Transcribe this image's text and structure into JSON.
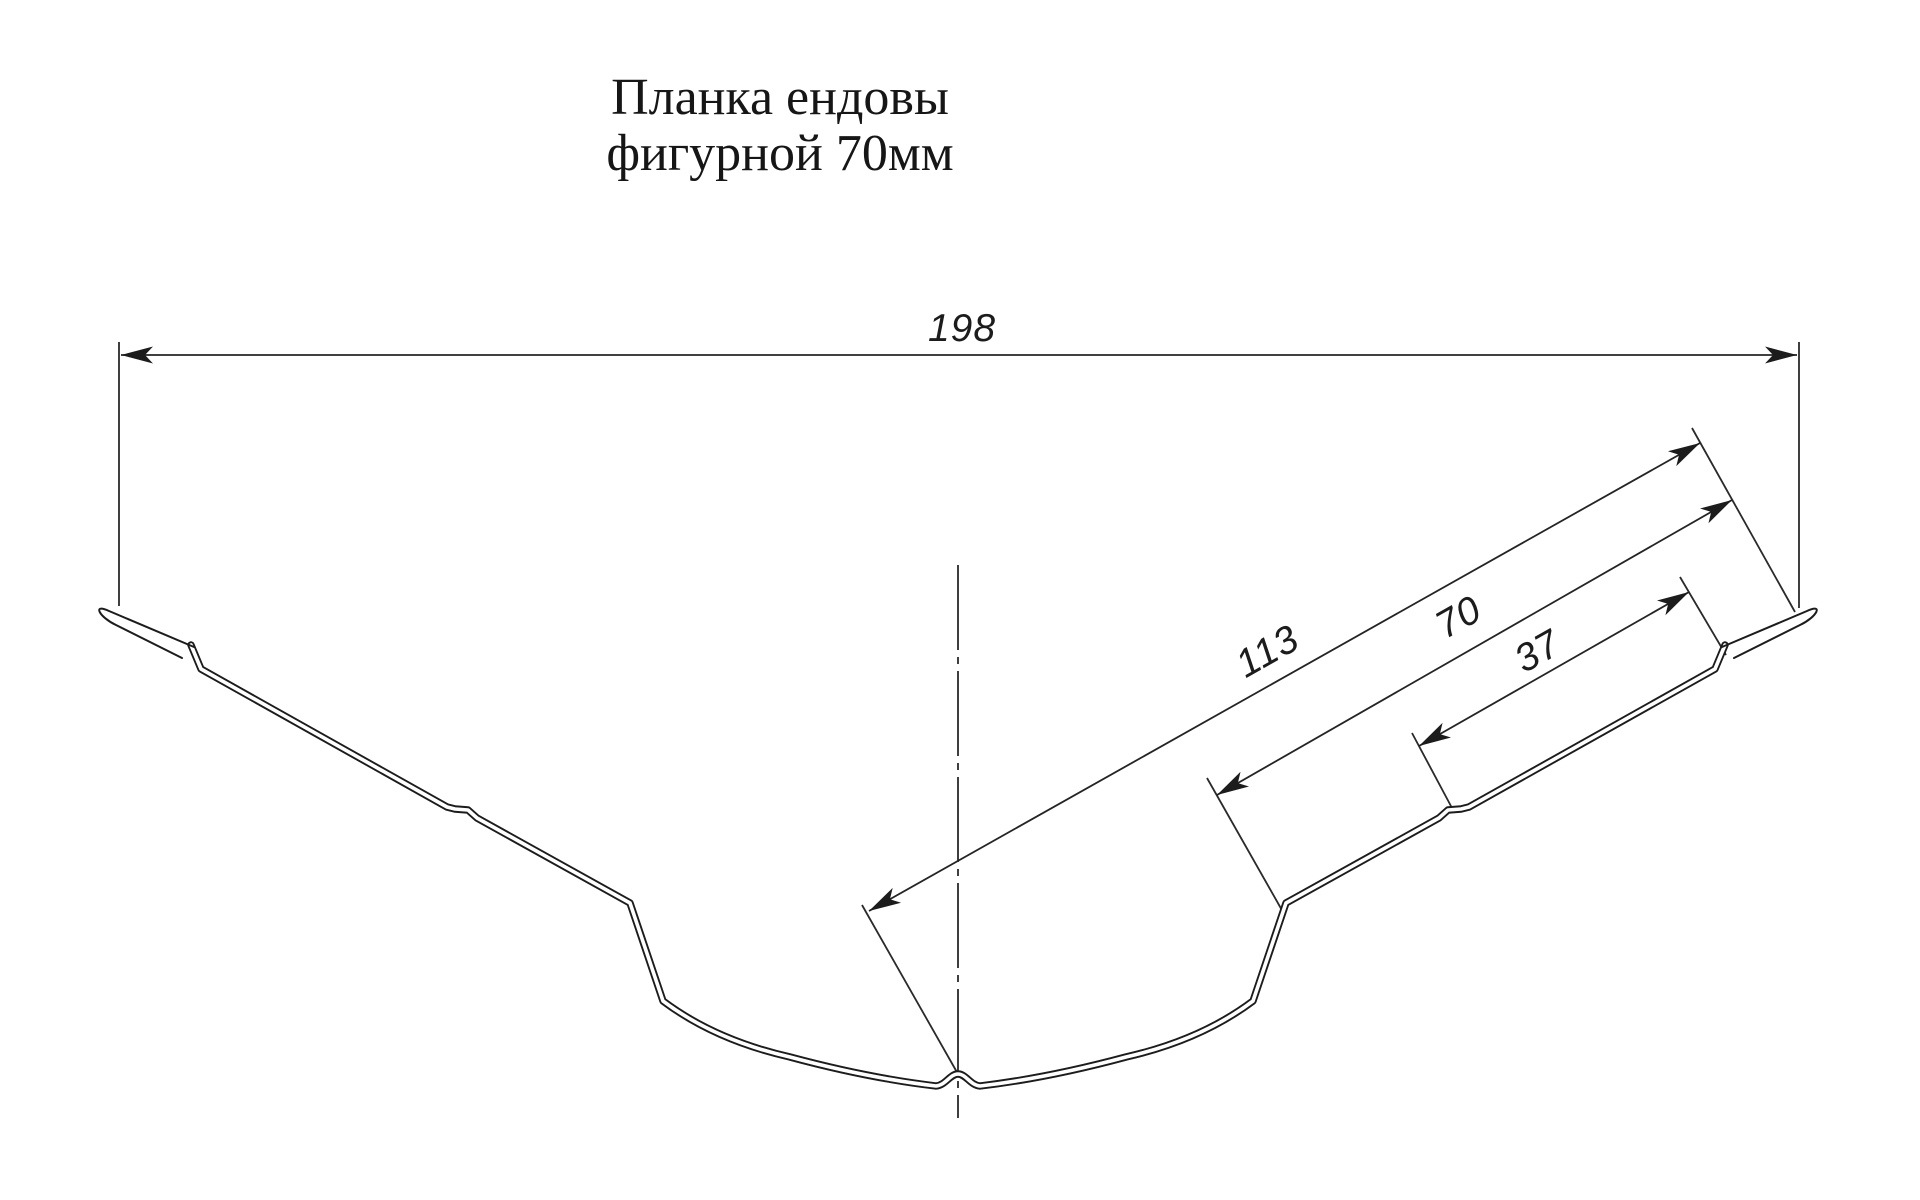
{
  "document": {
    "kind": "technical profile drawing",
    "background_color": "#ffffff",
    "ink_color": "#1c1c1c"
  },
  "title": {
    "line1": "Планка ендовы",
    "line2": "фигурной 70мм"
  },
  "dimensions": {
    "overall": {
      "label": "198"
    },
    "slope": {
      "label": "113"
    },
    "middle": {
      "label": "70"
    },
    "upper": {
      "label": "37"
    }
  }
}
